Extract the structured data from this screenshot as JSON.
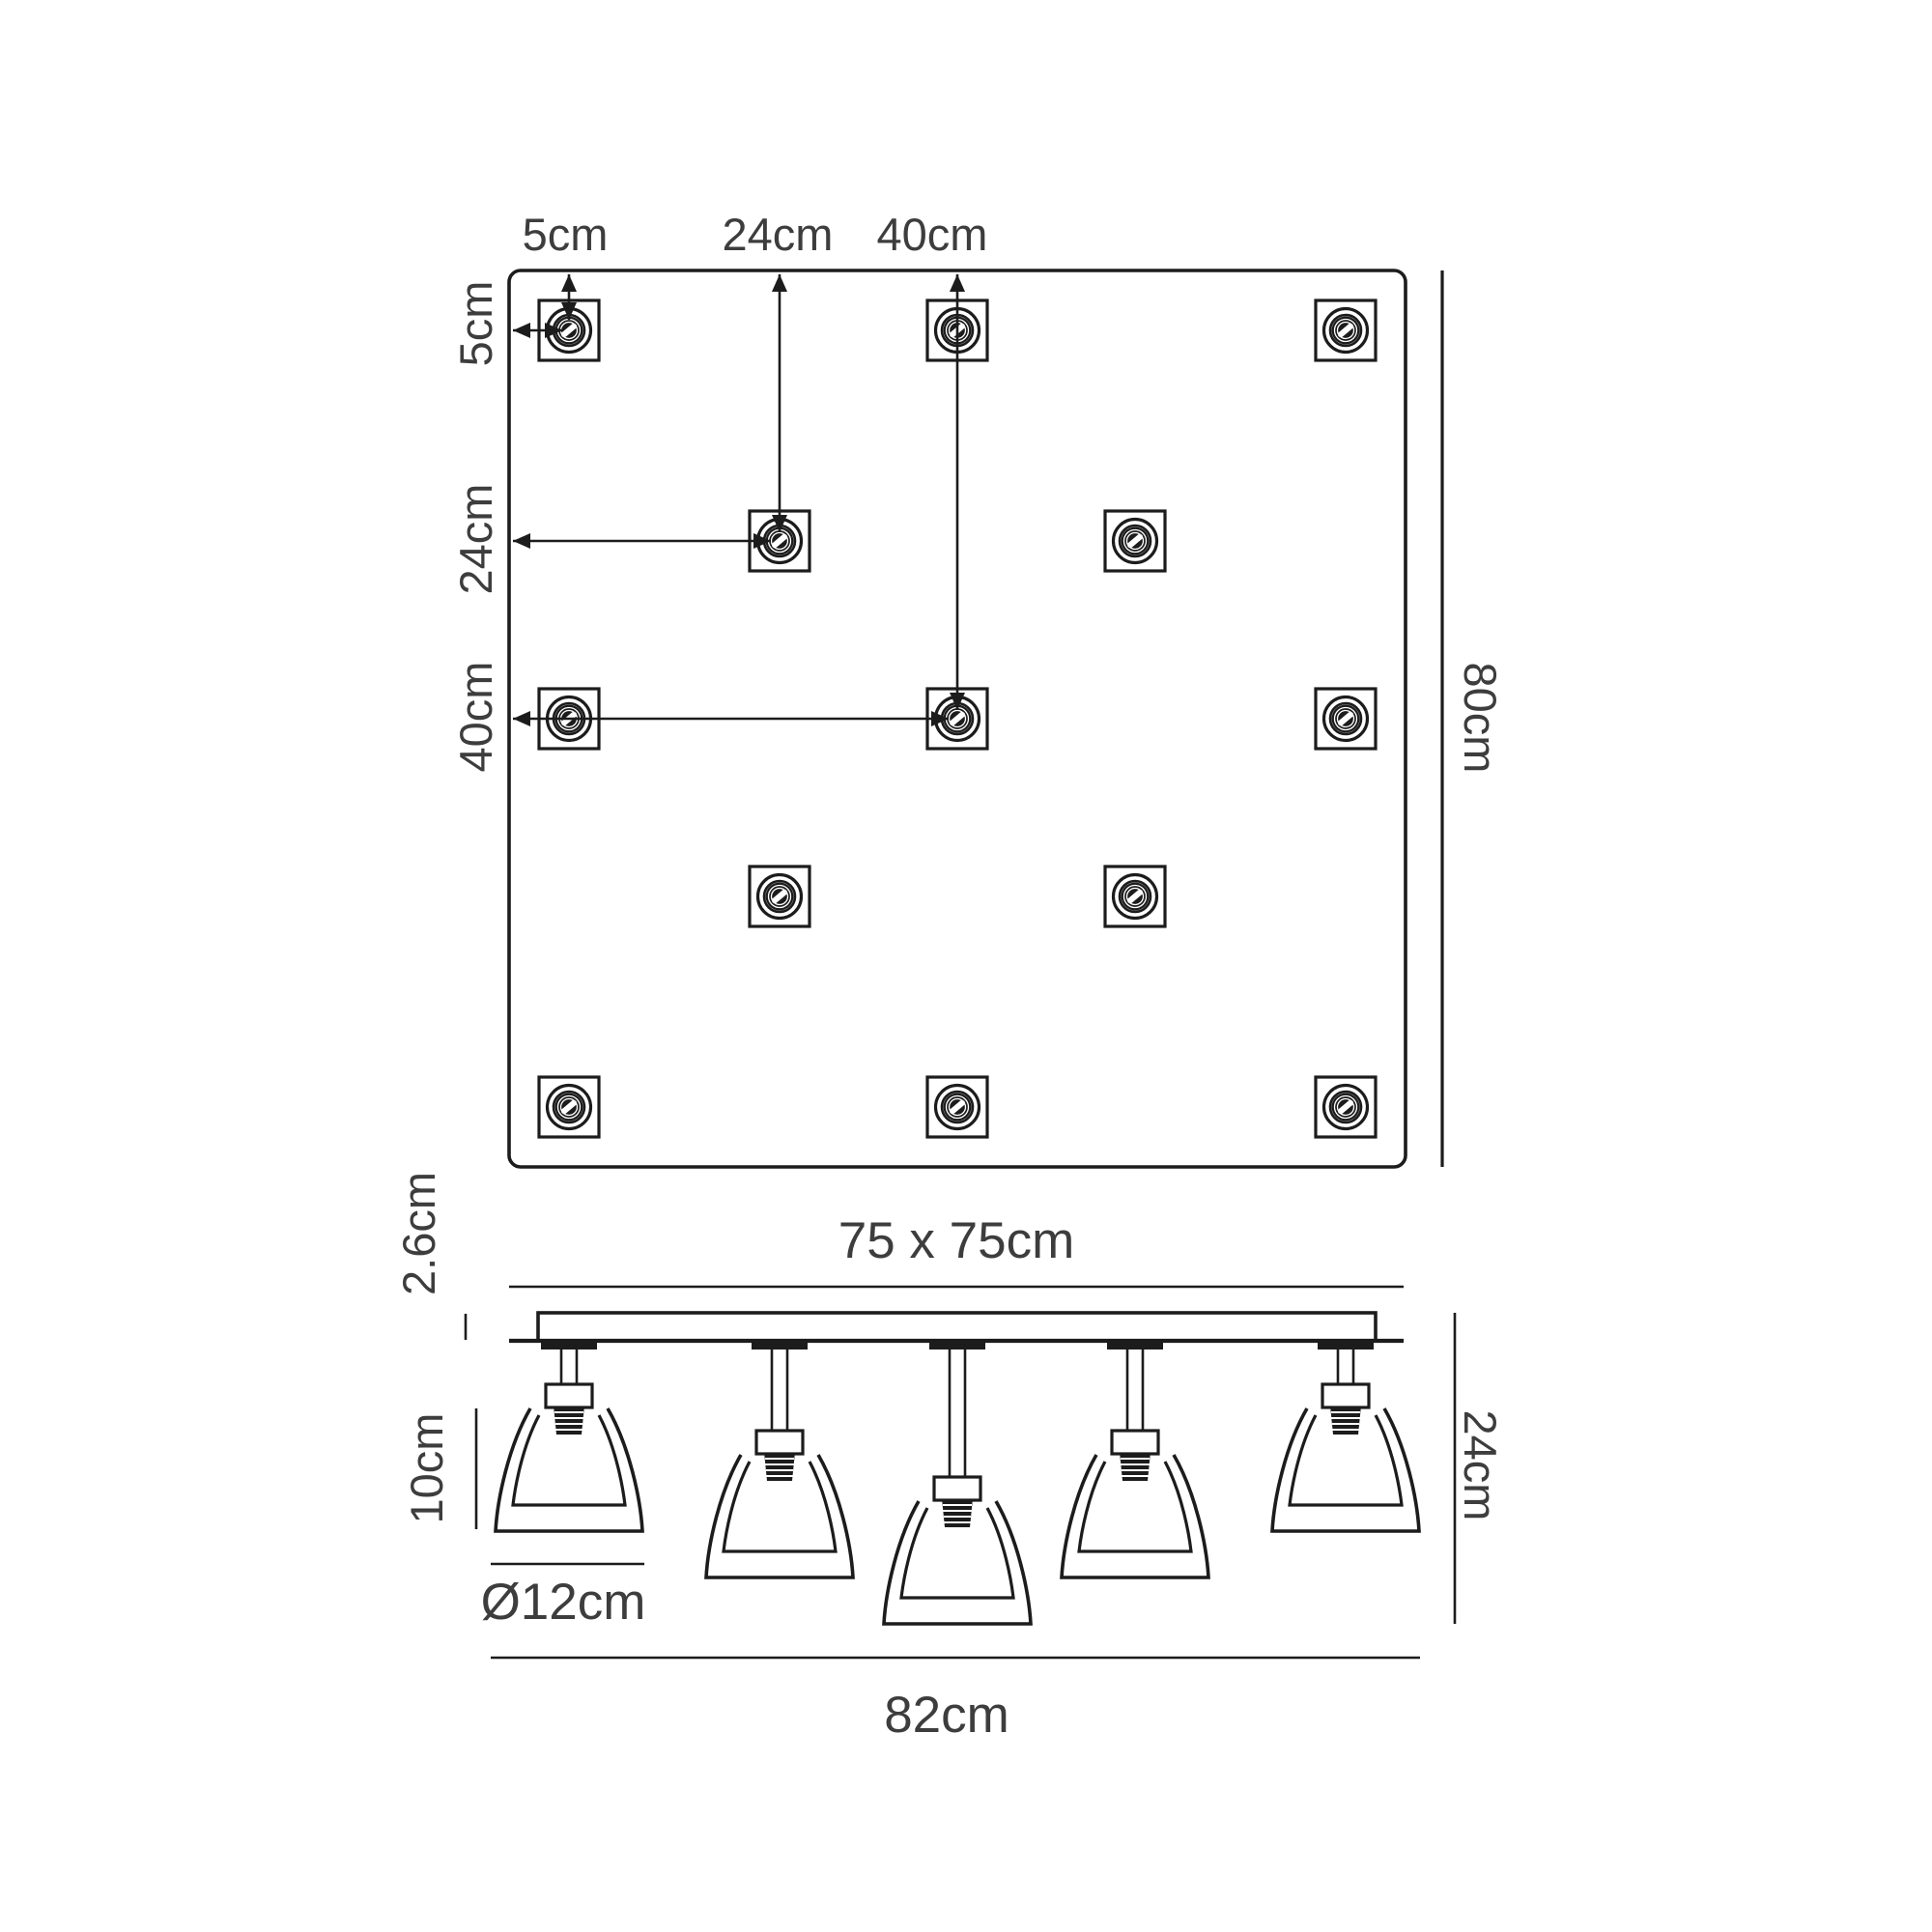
{
  "colors": {
    "line": "#1c1c1c",
    "text": "#3d3d3d",
    "background": "#ffffff"
  },
  "plan_view": {
    "description": "top view of square ceiling plate with lamp mounting positions",
    "mounting_point_count": 13,
    "top_dimension_labels": [
      {
        "label": "5cm"
      },
      {
        "label": "24cm"
      },
      {
        "label": "40cm"
      }
    ],
    "left_dimension_labels": [
      {
        "label": "5cm"
      },
      {
        "label": "24cm"
      },
      {
        "label": "40cm"
      }
    ],
    "right_dimension_label": {
      "label": "80cm"
    }
  },
  "side_view": {
    "description": "side elevation of 5-light flush ceiling fitting",
    "light_count": 5,
    "plate_size_label": "75 x 75cm",
    "plate_thickness_label": "2.6cm",
    "shade_height_label": "10cm",
    "shade_diameter_label": "Ø12cm",
    "fixture_height_label": "24cm",
    "fixture_width_label": "82cm"
  }
}
